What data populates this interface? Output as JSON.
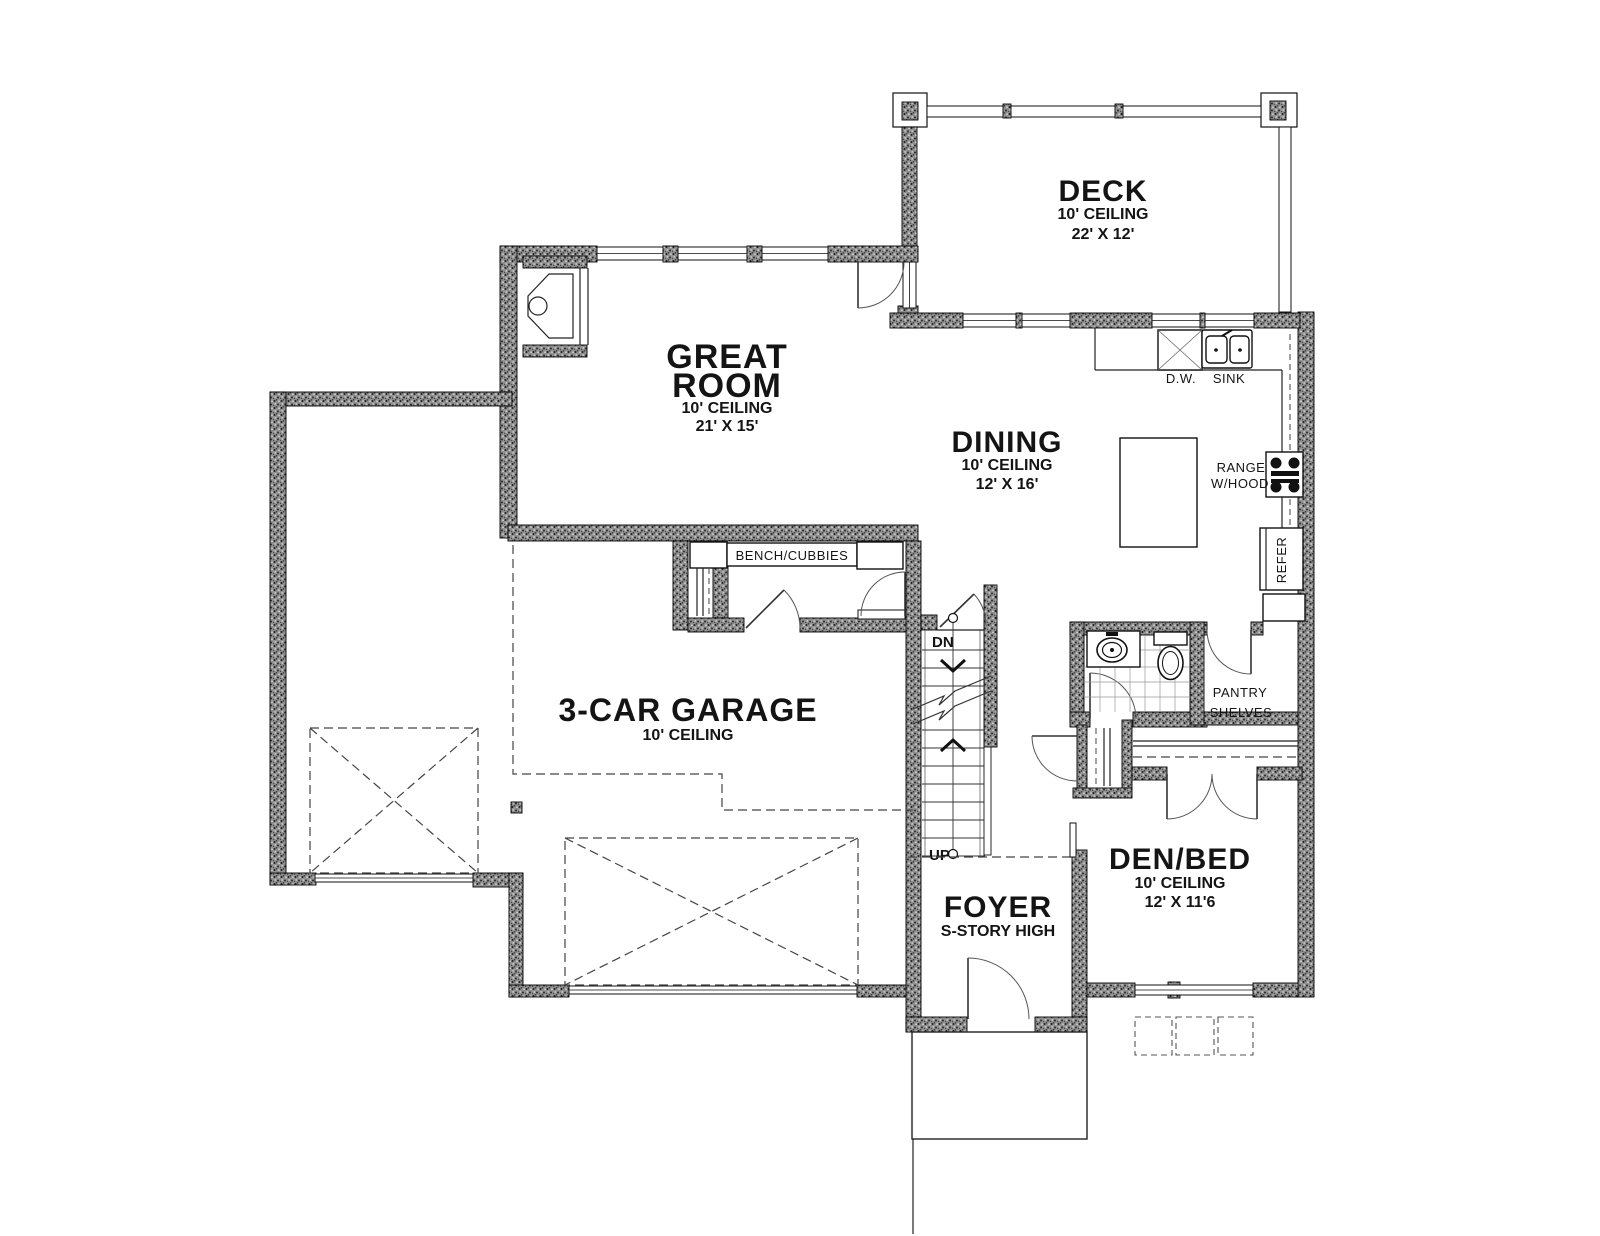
{
  "plan": {
    "rooms": {
      "deck": {
        "line1": "DECK",
        "line2": "10' CEILING",
        "line3": "22' X 12'"
      },
      "great_room": {
        "line1": "GREAT",
        "line2": "ROOM",
        "line3": "10' CEILING",
        "line4": "21' X 15'"
      },
      "dining": {
        "line1": "DINING",
        "line2": "10' CEILING",
        "line3": "12' X 16'"
      },
      "garage": {
        "line1": "3-CAR GARAGE",
        "line2": "10' CEILING"
      },
      "foyer": {
        "line1": "FOYER",
        "line2": "S-STORY HIGH"
      },
      "den": {
        "line1": "DEN/BED",
        "line2": "10' CEILING",
        "line3": "12' X 11'6"
      }
    },
    "labels": {
      "dishwasher": "D.W.",
      "sink": "SINK",
      "range1": "RANGE",
      "range2": "W/HOOD",
      "refrigerator": "REFER",
      "pantry1": "PANTRY",
      "pantry2": "SHELVES",
      "bench": "BENCH/CUBBIES",
      "down": "DN",
      "up": "UP"
    },
    "colors": {
      "background": "#ffffff",
      "wall_fill": "#8f8f8f",
      "line": "#111111"
    }
  }
}
